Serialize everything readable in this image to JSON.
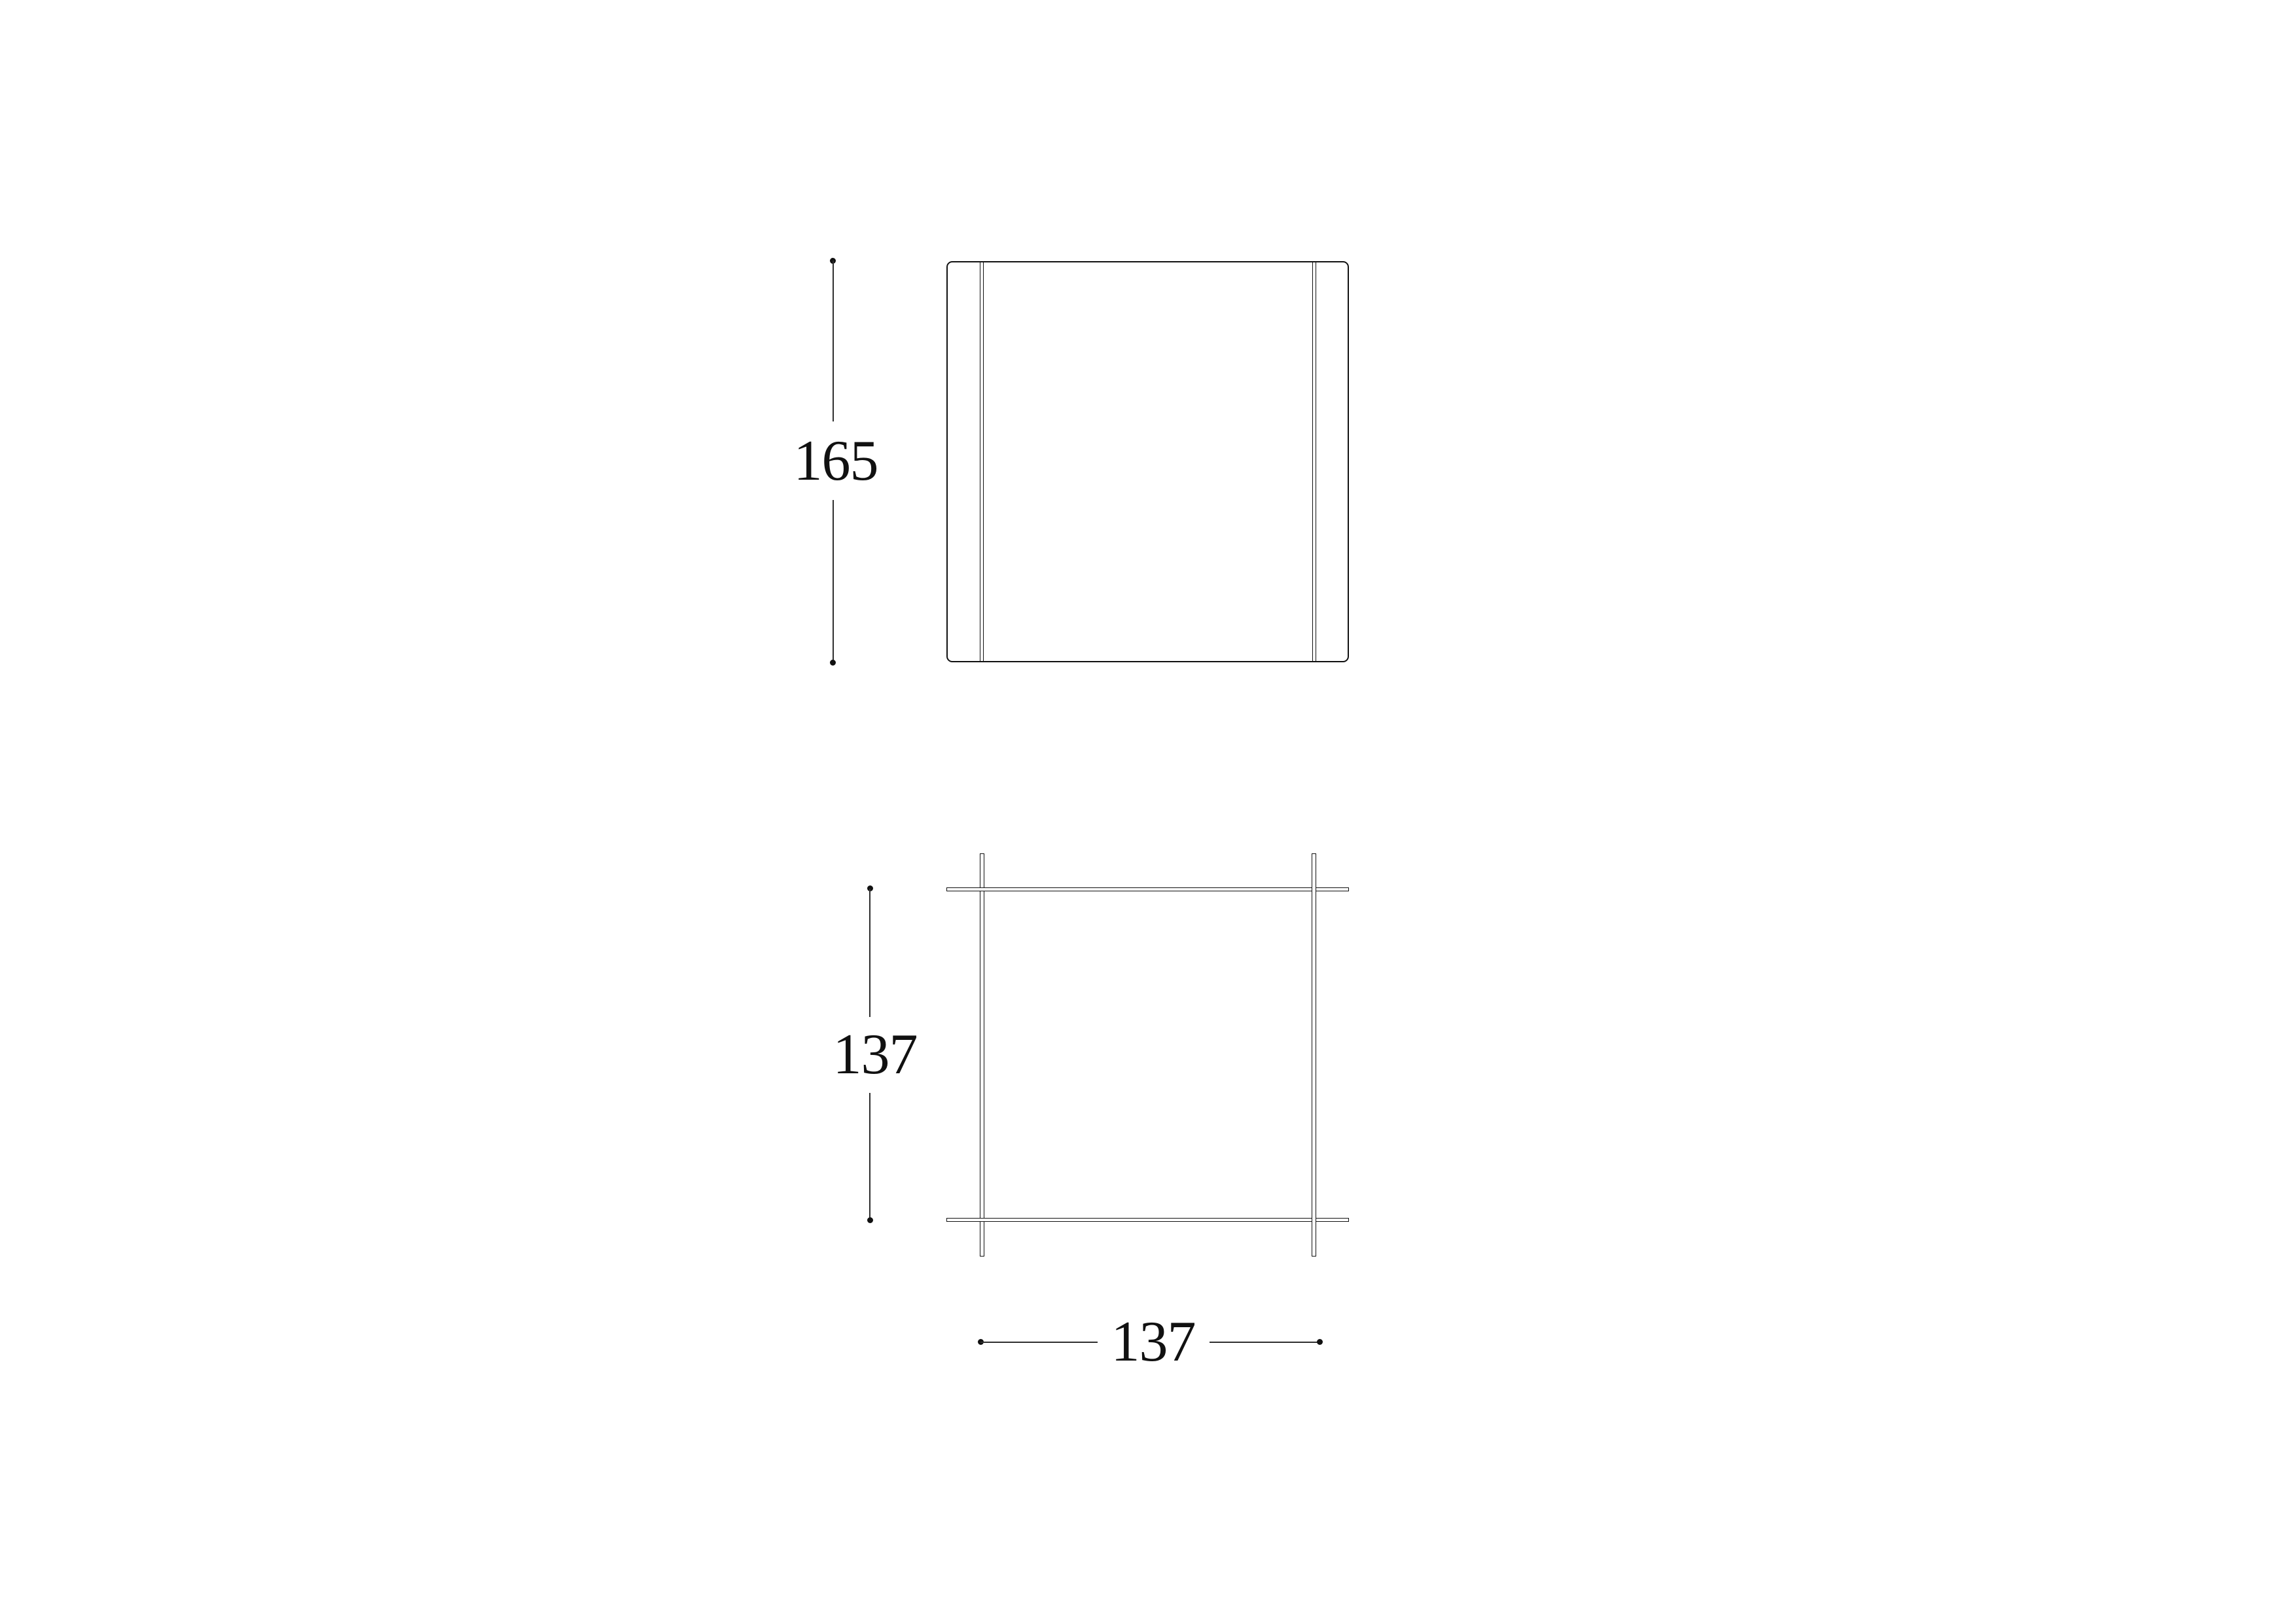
{
  "colors": {
    "line": "#111111",
    "dim": "#2f2f2f",
    "background": "#ffffff"
  },
  "drawing": {
    "type": "furniture-dimension-diagram",
    "views": {
      "front_view": {
        "name": "front elevation"
      },
      "plan_view": {
        "name": "top plan"
      }
    }
  },
  "dimensions": {
    "front_height": {
      "value": "165",
      "orientation": "vertical"
    },
    "plan_depth": {
      "value": "137",
      "orientation": "vertical"
    },
    "plan_width": {
      "value": "137",
      "orientation": "horizontal"
    }
  }
}
